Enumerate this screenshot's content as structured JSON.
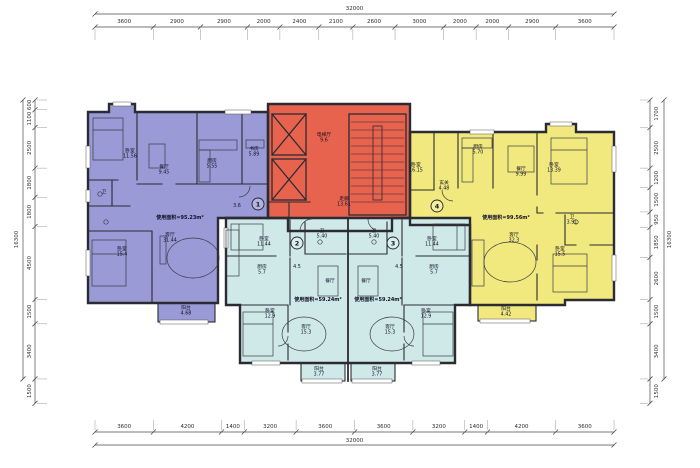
{
  "drawing": {
    "type": "residential-floor-plan",
    "colors": {
      "unit1_fill": "#9a9ad6",
      "core_fill": "#e8634e",
      "unit23_fill": "#cfe9e9",
      "unit4_fill": "#f1e97e",
      "wall": "#2b2b33",
      "dim_line": "#4a4a4a",
      "text": "#101028"
    },
    "dimensions": {
      "top": {
        "total": "32000",
        "segments": [
          "3600",
          "2900",
          "2900",
          "2000",
          "2400",
          "2100",
          "2600",
          "3000",
          "2000",
          "2000",
          "2900",
          "3600"
        ]
      },
      "bottom": {
        "total": "32000",
        "segments": [
          "3600",
          "4200",
          "1400",
          "3200",
          "3600",
          "3600",
          "3200",
          "1400",
          "4200",
          "3600"
        ]
      },
      "left": {
        "total": "16300",
        "segments": [
          "600",
          "1100",
          "2500",
          "1800",
          "1800",
          "4500",
          "1500",
          "3400",
          "1500"
        ]
      },
      "right": {
        "total": "16300",
        "segments": [
          "1700",
          "2500",
          "1200",
          "1500",
          "950",
          "1850",
          "2600",
          "1500",
          "3400",
          "1500"
        ]
      }
    },
    "units": [
      {
        "marker": "1",
        "x": 258,
        "y": 204,
        "area_text": "使用面积=95.23m²",
        "ax": 180,
        "ay": 219
      },
      {
        "marker": "2",
        "x": 297,
        "y": 243,
        "area_text": "使用面积=59.24m²",
        "ax": 318,
        "ay": 301
      },
      {
        "marker": "3",
        "x": 393,
        "y": 243,
        "area_text": "使用面积=59.24m²",
        "ax": 378,
        "ay": 301
      },
      {
        "marker": "4",
        "x": 437,
        "y": 206,
        "area_text": "使用面积=99.56m²",
        "ax": 506,
        "ay": 219
      }
    ],
    "room_labels": [
      {
        "x": 130,
        "y": 152,
        "lines": [
          "卧室",
          "11.56"
        ]
      },
      {
        "x": 164,
        "y": 168,
        "lines": [
          "餐厅",
          "9.45"
        ]
      },
      {
        "x": 212,
        "y": 162,
        "lines": [
          "厨房",
          "5.55"
        ]
      },
      {
        "x": 254,
        "y": 150,
        "lines": [
          "书房",
          "5.89"
        ]
      },
      {
        "x": 170,
        "y": 236,
        "lines": [
          "客厅",
          "31.44"
        ]
      },
      {
        "x": 122,
        "y": 250,
        "lines": [
          "卧室",
          "15.4"
        ]
      },
      {
        "x": 186,
        "y": 309,
        "lines": [
          "阳台",
          "4.68"
        ]
      },
      {
        "x": 104,
        "y": 193,
        "lines": [
          "卫"
        ]
      },
      {
        "x": 237,
        "y": 207,
        "lines": [
          "3.6"
        ]
      },
      {
        "x": 324,
        "y": 136,
        "lines": [
          "电梯厅",
          "9.6"
        ]
      },
      {
        "x": 344,
        "y": 200,
        "lines": [
          "走廊",
          "13.61"
        ]
      },
      {
        "x": 264,
        "y": 240,
        "lines": [
          "卧室",
          "11.44"
        ]
      },
      {
        "x": 322,
        "y": 232,
        "lines": [
          "卫",
          "5.40"
        ]
      },
      {
        "x": 262,
        "y": 268,
        "lines": [
          "厨房",
          "5.7"
        ]
      },
      {
        "x": 297,
        "y": 268,
        "lines": [
          "4.5"
        ]
      },
      {
        "x": 330,
        "y": 282,
        "lines": [
          "餐厅"
        ]
      },
      {
        "x": 270,
        "y": 312,
        "lines": [
          "卧室",
          "12.9"
        ]
      },
      {
        "x": 306,
        "y": 328,
        "lines": [
          "客厅",
          "15.3"
        ]
      },
      {
        "x": 319,
        "y": 370,
        "lines": [
          "阳台",
          "3.77"
        ]
      },
      {
        "x": 432,
        "y": 240,
        "lines": [
          "卧室",
          "11.44"
        ]
      },
      {
        "x": 374,
        "y": 232,
        "lines": [
          "卫",
          "5.40"
        ]
      },
      {
        "x": 434,
        "y": 268,
        "lines": [
          "厨房",
          "5.7"
        ]
      },
      {
        "x": 399,
        "y": 268,
        "lines": [
          "4.5"
        ]
      },
      {
        "x": 366,
        "y": 282,
        "lines": [
          "餐厅"
        ]
      },
      {
        "x": 426,
        "y": 312,
        "lines": [
          "卧室",
          "12.9"
        ]
      },
      {
        "x": 390,
        "y": 328,
        "lines": [
          "客厅",
          "15.3"
        ]
      },
      {
        "x": 377,
        "y": 370,
        "lines": [
          "阳台",
          "3.77"
        ]
      },
      {
        "x": 416,
        "y": 166,
        "lines": [
          "卧室",
          "16.15"
        ]
      },
      {
        "x": 478,
        "y": 148,
        "lines": [
          "厨房",
          "5.70"
        ]
      },
      {
        "x": 444,
        "y": 184,
        "lines": [
          "玄关",
          "4.48"
        ]
      },
      {
        "x": 521,
        "y": 170,
        "lines": [
          "餐厅",
          "9.99"
        ]
      },
      {
        "x": 554,
        "y": 166,
        "lines": [
          "卧室",
          "13.39"
        ]
      },
      {
        "x": 514,
        "y": 236,
        "lines": [
          "客厅",
          "32.3"
        ]
      },
      {
        "x": 560,
        "y": 250,
        "lines": [
          "卧室",
          "15.5"
        ]
      },
      {
        "x": 572,
        "y": 218,
        "lines": [
          "卫",
          "3.91"
        ]
      },
      {
        "x": 506,
        "y": 310,
        "lines": [
          "阳台",
          "4.42"
        ]
      }
    ]
  }
}
